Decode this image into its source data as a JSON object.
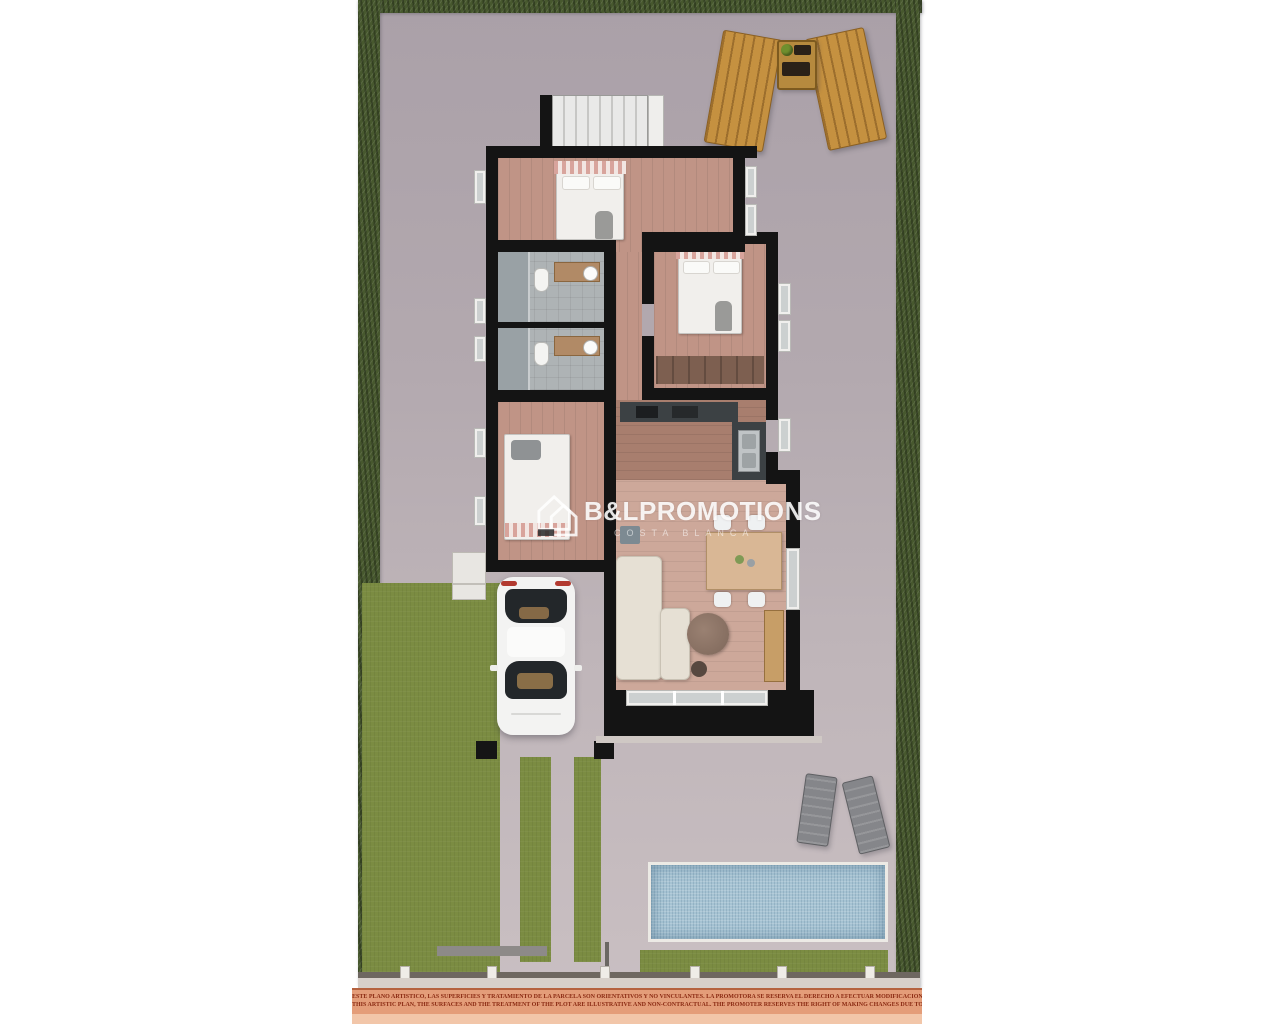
{
  "watermark": {
    "brand": "B&L",
    "brand_suffix": "PROMOTIONS",
    "subtitle": "COSTA BLANCA"
  },
  "disclaimer": {
    "line_spanish": "ESTE PLANO ARTISTICO, LAS SUPERFICIES Y TRATAMIENTO DE LA PARCELA SON ORIENTATIVOS Y NO VINCULANTES. LA PROMOTORA SE RESERVA EL DERECHO A EFECTUAR MODIFICACIONES POR CUALQUIER NECESIDAD",
    "line_english": "THIS ARTISTIC PLAN, THE SURFACES AND THE TREATMENT OF THE PLOT ARE ILLUSTRATIVE AND NON-CONTRACTUAL. THE PROMOTER RESERVES THE RIGHT OF MAKING CHANGES DUE TO ANY NECESSITY"
  },
  "colors": {
    "hedge": "#47582e",
    "lawn": "#7b8c42",
    "pool-water": "#a6c3d3",
    "ground-top": "#aaa0a8",
    "ground-bottom": "#c9bfc2",
    "wall": "#141414",
    "wood-lounger": "#c59140",
    "bedroom-floor": "#c09486",
    "living-floor": "#cda89a",
    "disclaimer-bg": "#e49d79",
    "disclaimer-text": "#8a2a12"
  }
}
